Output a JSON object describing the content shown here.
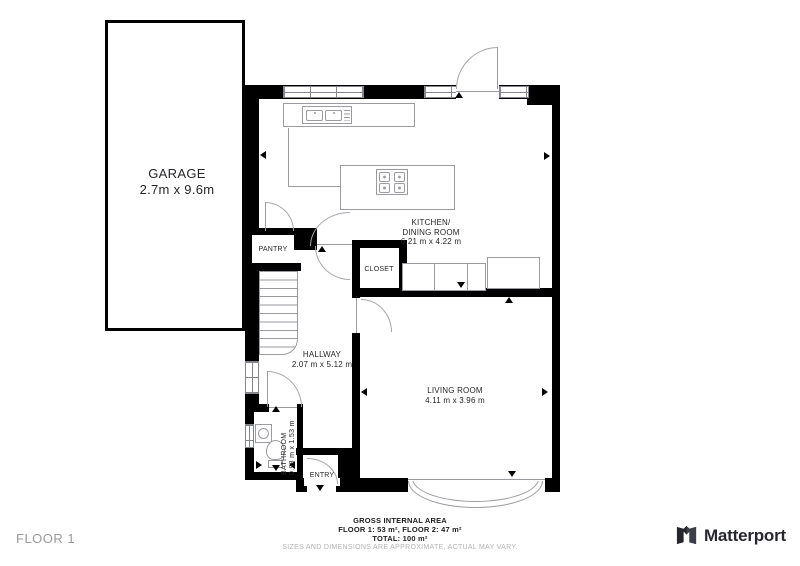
{
  "plan": {
    "garage": {
      "name": "GARAGE",
      "dims": "2.7m x 9.6m"
    },
    "kitchen": {
      "line1": "KITCHEN/",
      "line2": "DINING ROOM",
      "dims": "6.21 m x 4.22 m"
    },
    "pantry": {
      "name": "PANTRY"
    },
    "closet": {
      "name": "CLOSET"
    },
    "hallway": {
      "name": "HALLWAY",
      "dims": "2.07 m x 5.12 m"
    },
    "living": {
      "name": "LIVING ROOM",
      "dims": "4.11 m x 3.96 m"
    },
    "bathroom": {
      "name": "BATHROOM",
      "dims": "0.98 m x 1.53 m"
    },
    "entry": {
      "name": "ENTRY"
    }
  },
  "footer": {
    "area_title": "GROSS INTERNAL AREA",
    "floors": "FLOOR 1: 53 m², FLOOR 2: 47 m²",
    "total": "TOTAL: 100 m²",
    "disclaimer": "SIZES AND DIMENSIONS ARE APPROXIMATE, ACTUAL MAY VARY.",
    "floor_label": "FLOOR 1",
    "brand": "Matterport"
  },
  "colors": {
    "wall": "#000000",
    "fixture": "#9a9aa0",
    "text": "#26262a",
    "muted": "#b4b4b4",
    "brand": "#26262e"
  }
}
